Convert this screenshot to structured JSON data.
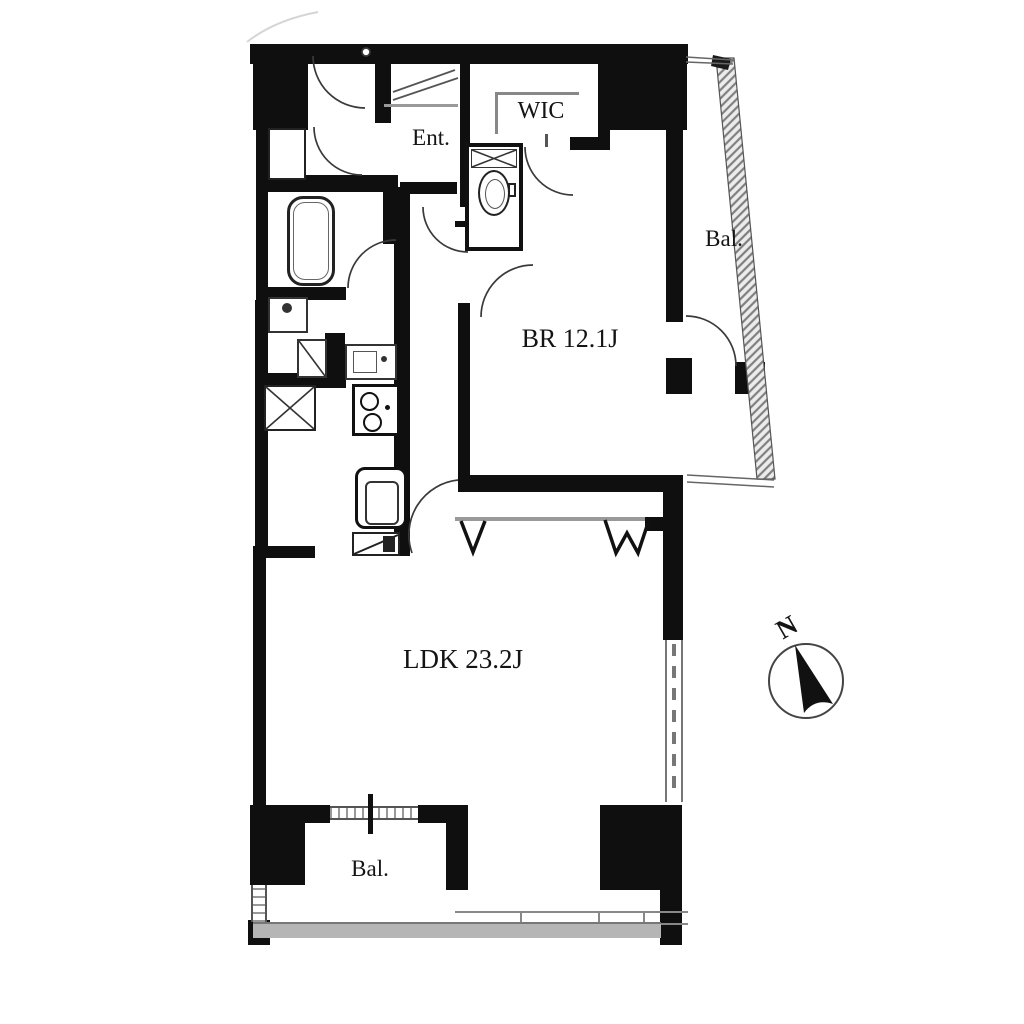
{
  "floorplan": {
    "labels": {
      "entrance": "Ent.",
      "walk_in_closet": "WIC",
      "balcony_east": "Bal.",
      "bedroom": "BR 12.1J",
      "living_dining_kitchen": "LDK 23.2J",
      "balcony_south": "Bal.",
      "compass_north": "N"
    },
    "colors": {
      "wall": "#0f0f0f",
      "thin_line": "#3a3a3a",
      "balcony_floor": "#b5b5b5",
      "background": "#ffffff"
    },
    "fixture_icons": [
      "bathtub-icon",
      "toilet-icon",
      "washbasin-icon",
      "washing-machine-pan-icon",
      "kitchen-sink-icon",
      "stove-icon",
      "storage-x-box-icon",
      "water-heater-icon",
      "refrigerator-marker-icon",
      "closet-hanger-marks-icon",
      "compass-icon"
    ]
  }
}
